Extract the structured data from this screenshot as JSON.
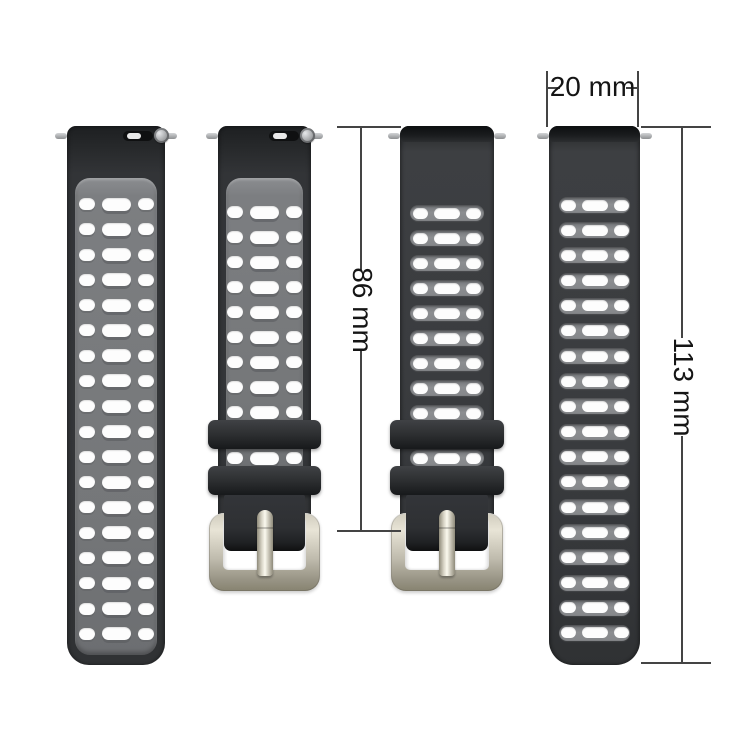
{
  "annotations": {
    "width_label": "20 mm",
    "short_length_label": "86 mm",
    "long_length_label": "113 mm"
  },
  "colors": {
    "background": "#ffffff",
    "strap_black": "#343639",
    "strap_black_dark": "#17191b",
    "inner_panel_gray": "#77797c",
    "groove_gray": "#85878a",
    "hole_white": "#fdfdfd",
    "buckle_silver_light": "#e8e4d6",
    "buckle_silver_dark": "#878370",
    "spring_pin_silver": "#b0b2b4",
    "dimension_line": "#444444",
    "dimension_text": "#151515"
  },
  "straps": [
    {
      "name": "long-strap-inner-side",
      "side": "inner-gray",
      "length_rows": 18,
      "rows_between_keepers": 0,
      "has_buckle": false,
      "quick_release_visible": true
    },
    {
      "name": "short-strap-inner-side",
      "side": "inner-gray",
      "length_rows": 9,
      "rows_between_keepers": 1,
      "has_buckle": true,
      "quick_release_visible": true
    },
    {
      "name": "short-strap-outer-side",
      "side": "outer-black",
      "length_rows": 9,
      "rows_between_keepers": 1,
      "has_buckle": true,
      "quick_release_visible": false
    },
    {
      "name": "long-strap-outer-side",
      "side": "outer-black",
      "length_rows": 18,
      "rows_between_keepers": 0,
      "has_buckle": false,
      "quick_release_visible": false
    }
  ]
}
